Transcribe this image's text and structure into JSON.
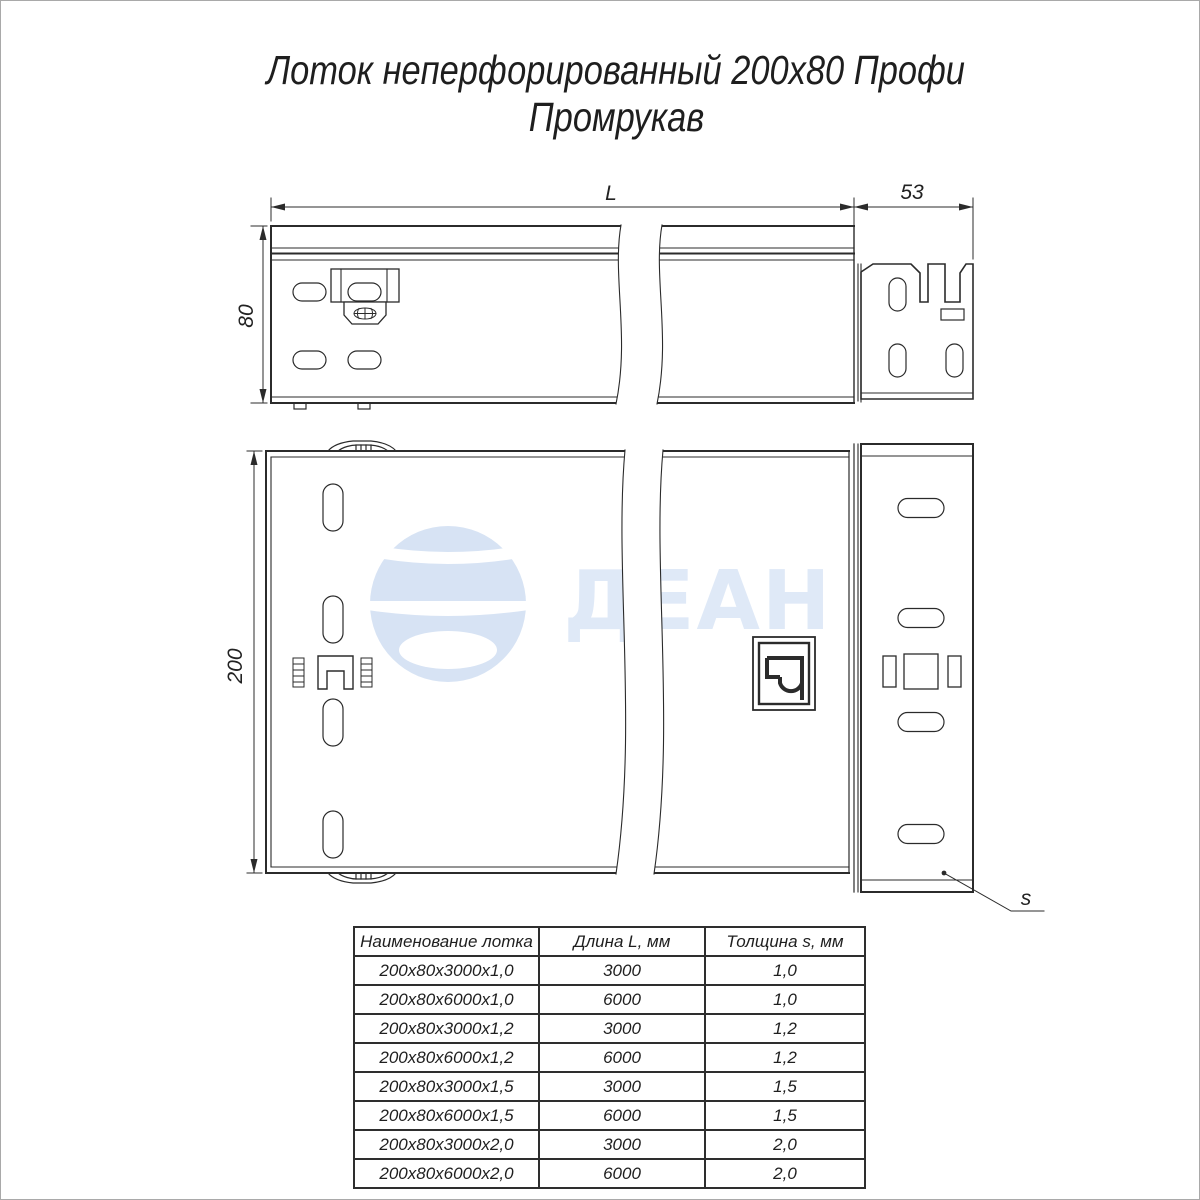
{
  "title": {
    "line1": "Лоток неперфорированный 200х80 Профи",
    "line2": "Промрукав"
  },
  "watermark": {
    "text": "ДЕАН",
    "sphere_color": "#d7e3f4",
    "text_color": "#dfe9f7"
  },
  "dimensions": {
    "length_label": "L",
    "end_piece_width": "53",
    "side_height": "80",
    "tray_width": "200",
    "thickness_label": "s"
  },
  "table": {
    "headers": [
      "Наименование лотка",
      "Длина L, мм",
      "Толщина s, мм"
    ],
    "rows": [
      [
        "200х80х3000х1,0",
        "3000",
        "1,0"
      ],
      [
        "200х80х6000х1,0",
        "6000",
        "1,0"
      ],
      [
        "200х80х3000х1,2",
        "3000",
        "1,2"
      ],
      [
        "200х80х6000х1,2",
        "6000",
        "1,2"
      ],
      [
        "200х80х3000х1,5",
        "3000",
        "1,5"
      ],
      [
        "200х80х6000х1,5",
        "6000",
        "1,5"
      ],
      [
        "200х80х3000х2,0",
        "3000",
        "2,0"
      ],
      [
        "200х80х6000х2,0",
        "6000",
        "2,0"
      ]
    ]
  },
  "colors": {
    "line": "#2b2b2b",
    "text": "#1f1f1f"
  }
}
